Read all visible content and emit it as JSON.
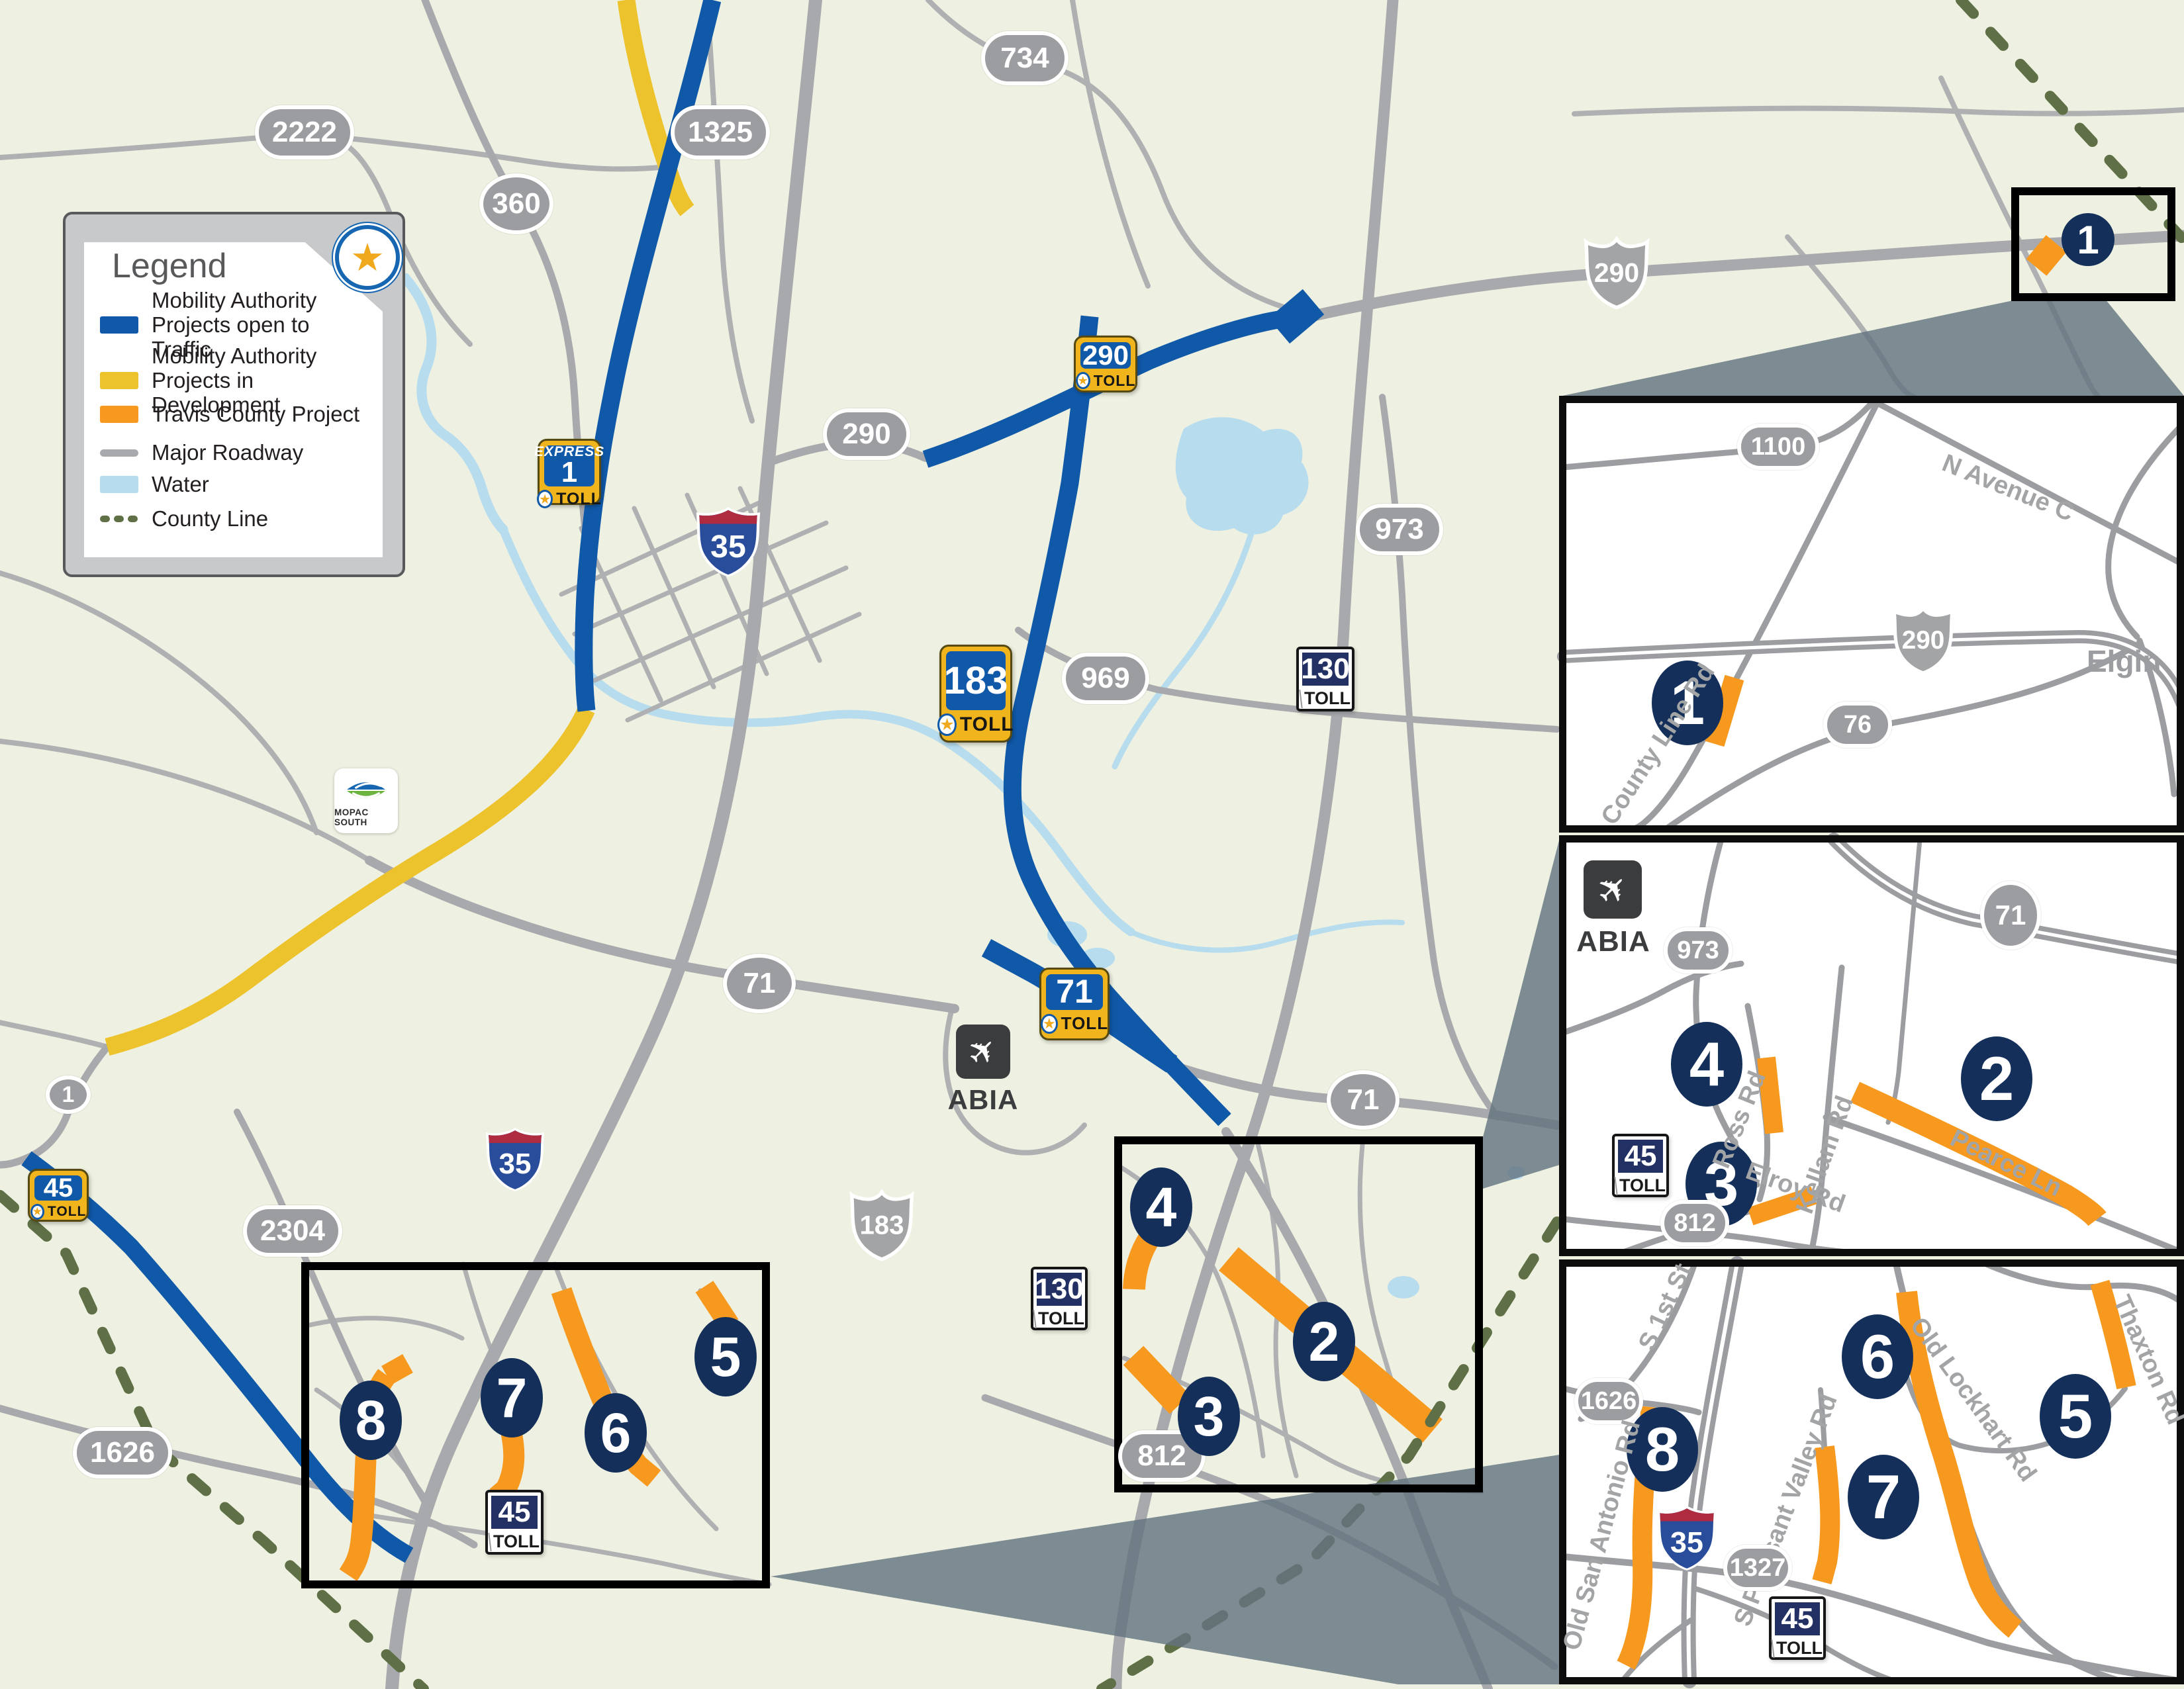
{
  "legend": {
    "title": "Legend",
    "items": [
      {
        "label": "Mobility Authority Projects open to Traffic",
        "color": "#1059a9"
      },
      {
        "label": "Mobility Authority Projects in Development",
        "color": "#edc32d"
      },
      {
        "label": "Travis County Project",
        "color": "#f6991e"
      },
      {
        "label": "Major Roadway",
        "color": "#a7a9ac"
      },
      {
        "label": "Water",
        "color": "#b7dcee"
      },
      {
        "label": "County Line",
        "color": "#5f7046"
      }
    ]
  },
  "markers": {
    "m1": "1",
    "m2": "2",
    "m3": "3",
    "m4": "4",
    "m5": "5",
    "m6": "6",
    "m7": "7",
    "m8": "8"
  },
  "shields": {
    "pill_2222": "2222",
    "pill_360": "360",
    "pill_1325": "1325",
    "pill_734": "734",
    "pill_290_downtown": "290",
    "pill_969": "969",
    "pill_973": "973",
    "pill_71_west": "71",
    "pill_71_east": "71",
    "pill_1_ranch": "1",
    "pill_2304": "2304",
    "pill_1626": "1626",
    "pill_812": "812",
    "us_290_elgin": "290",
    "us_183_south": "183",
    "interstate_35": "35",
    "toll_express_num": "1",
    "toll_290": "290",
    "toll_183": "183",
    "toll_71": "71",
    "toll_45": "45",
    "txdot_130": "130",
    "txdot_45": "45",
    "inset_pill_1100": "1100",
    "inset_us_290": "290",
    "inset_pill_76": "76",
    "inset_pill_973": "973",
    "inset_pill_71": "71",
    "inset_pill_812": "812",
    "inset_pill_1626": "1626",
    "inset_pill_1327": "1327"
  },
  "labels": {
    "toll": "TOLL",
    "express": "EXPRESS",
    "mopac_south": "MoPac South",
    "abia": "ABIA",
    "elgin": "Elgin",
    "n_avenue_c": "N Avenue C",
    "county_line_rd": "County Line Rd",
    "ross_rd": "Ross Rd",
    "kellam_rd": "Kellam Rd",
    "pearce_ln": "Pearce Ln",
    "elroy_rd": "Elroy Rd",
    "s_1st_st": "S 1st St",
    "old_san_antonio_rd": "Old San Antonio Rd",
    "old_lockhart_rd": "Old Lockhart Rd",
    "thaxton_rd": "Thaxton Rd",
    "s_pleasant_valley_rd": "S Pleasant Valley Rd"
  },
  "colors": {
    "open_to_traffic": "#1059a9",
    "in_development": "#edc32d",
    "travis_county": "#f6991e",
    "major_roadway": "#a7a9ac",
    "water": "#b7dcee",
    "county_line": "#5f7046",
    "marker_navy": "#14305a"
  }
}
